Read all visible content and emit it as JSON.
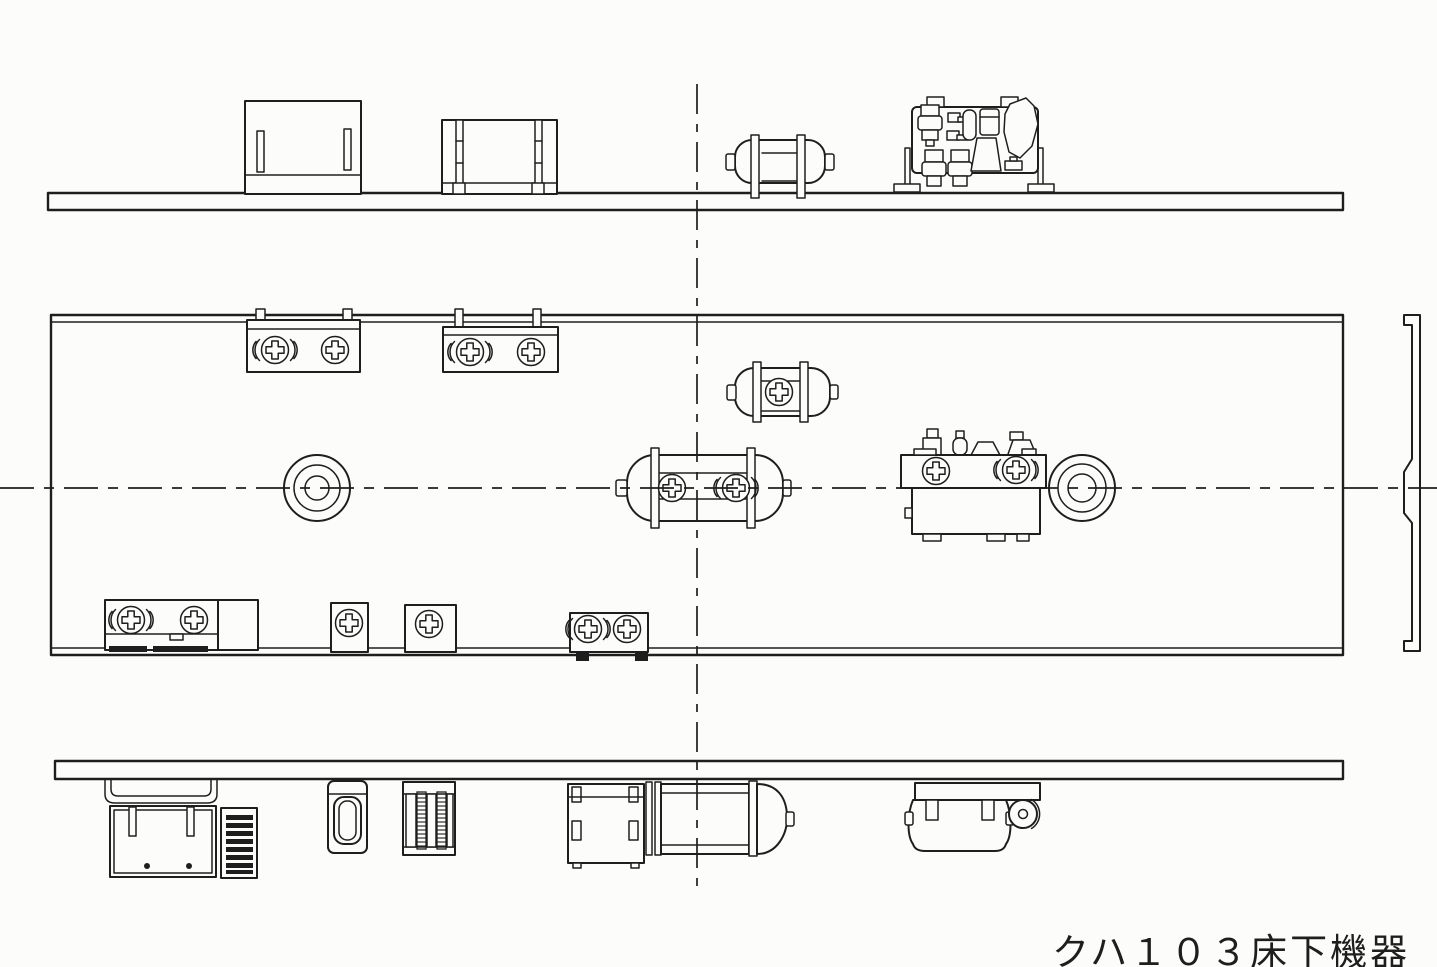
{
  "meta": {
    "caption": "クハ１０３床下機器",
    "background": "#fcfcfa",
    "ink": "#1e1e1e",
    "drawing_type": "technical line drawing, three views with dash-dot centerlines"
  },
  "views": [
    {
      "id": "side-view-a",
      "parts": [
        "floor-bar",
        "equipment-box",
        "equipment-box",
        "air-reservoir",
        "brake-control-unit"
      ]
    },
    {
      "id": "plan-view",
      "parts": [
        "underframe-outline",
        "junction-box",
        "junction-box",
        "air-reservoir-small",
        "air-reservoir-main",
        "drain-circle",
        "brake-control-unit",
        "drain-circle",
        "terminal-box",
        "terminal-box",
        "terminal-box",
        "terminal-box",
        "end-beam"
      ]
    },
    {
      "id": "side-view-b",
      "parts": [
        "floor-bar",
        "hanger-bracket",
        "battery-box",
        "louver-grid",
        "valve-box",
        "resistor-unit",
        "junction-box",
        "air-cylinder",
        "compressor"
      ]
    }
  ],
  "symbols": [
    "mounting-screw-icon",
    "flanged-screw-icon",
    "centerline-dashdot"
  ]
}
